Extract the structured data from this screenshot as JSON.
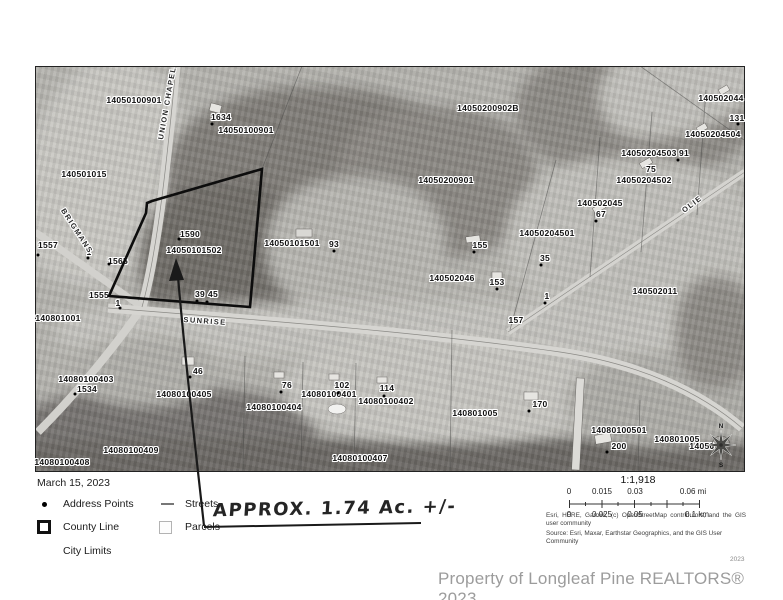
{
  "map": {
    "labels": [
      {
        "t": "14050100901",
        "x": 134,
        "y": 100
      },
      {
        "t": "1634",
        "x": 221,
        "y": 117
      },
      {
        "t": "14050100901",
        "x": 246,
        "y": 130
      },
      {
        "t": "140501015",
        "x": 84,
        "y": 174
      },
      {
        "t": "14050200902B",
        "x": 488,
        "y": 108
      },
      {
        "t": "14050200901",
        "x": 446,
        "y": 180
      },
      {
        "t": "140502044",
        "x": 721,
        "y": 98
      },
      {
        "t": "131",
        "x": 737,
        "y": 118
      },
      {
        "t": "14050204504",
        "x": 713,
        "y": 134
      },
      {
        "t": "14050204503",
        "x": 649,
        "y": 153
      },
      {
        "t": "91",
        "x": 684,
        "y": 153
      },
      {
        "t": "75",
        "x": 651,
        "y": 169
      },
      {
        "t": "14050204502",
        "x": 644,
        "y": 180
      },
      {
        "t": "140502045",
        "x": 600,
        "y": 203
      },
      {
        "t": "67",
        "x": 601,
        "y": 214
      },
      {
        "t": "14050204501",
        "x": 547,
        "y": 233
      },
      {
        "t": "140502011",
        "x": 655,
        "y": 291
      },
      {
        "t": "1557",
        "x": 48,
        "y": 245
      },
      {
        "t": "1",
        "x": 89,
        "y": 252
      },
      {
        "t": "1565",
        "x": 118,
        "y": 261
      },
      {
        "t": "1555",
        "x": 99,
        "y": 295
      },
      {
        "t": "1",
        "x": 118,
        "y": 303
      },
      {
        "t": "140801001",
        "x": 58,
        "y": 318
      },
      {
        "t": "1590",
        "x": 190,
        "y": 234
      },
      {
        "t": "14050101502",
        "x": 194,
        "y": 250
      },
      {
        "t": "39",
        "x": 200,
        "y": 294
      },
      {
        "t": "45",
        "x": 213,
        "y": 294
      },
      {
        "t": "14050101501",
        "x": 292,
        "y": 243
      },
      {
        "t": "93",
        "x": 334,
        "y": 244
      },
      {
        "t": "155",
        "x": 480,
        "y": 245
      },
      {
        "t": "35",
        "x": 545,
        "y": 258
      },
      {
        "t": "140502046",
        "x": 452,
        "y": 278
      },
      {
        "t": "153",
        "x": 497,
        "y": 282
      },
      {
        "t": "1",
        "x": 547,
        "y": 296
      },
      {
        "t": "157",
        "x": 516,
        "y": 320
      },
      {
        "t": "14080100403",
        "x": 86,
        "y": 379
      },
      {
        "t": "1534",
        "x": 87,
        "y": 389
      },
      {
        "t": "46",
        "x": 198,
        "y": 371
      },
      {
        "t": "14080100405",
        "x": 184,
        "y": 394
      },
      {
        "t": "76",
        "x": 287,
        "y": 385
      },
      {
        "t": "14080100404",
        "x": 274,
        "y": 407
      },
      {
        "t": "102",
        "x": 342,
        "y": 385
      },
      {
        "t": "14080100401",
        "x": 329,
        "y": 394
      },
      {
        "t": "114",
        "x": 387,
        "y": 388
      },
      {
        "t": "14080100402",
        "x": 386,
        "y": 401
      },
      {
        "t": "14080100407",
        "x": 360,
        "y": 458
      },
      {
        "t": "14080100409",
        "x": 131,
        "y": 450
      },
      {
        "t": "14080100408",
        "x": 62,
        "y": 462
      },
      {
        "t": "140801005",
        "x": 475,
        "y": 413
      },
      {
        "t": "170",
        "x": 540,
        "y": 404
      },
      {
        "t": "14080100501",
        "x": 619,
        "y": 430
      },
      {
        "t": "200",
        "x": 619,
        "y": 446
      },
      {
        "t": "140801005",
        "x": 677,
        "y": 439
      },
      {
        "t": "14050",
        "x": 702,
        "y": 446
      },
      {
        "t": "UNION CHAPEL",
        "x": 167,
        "y": 103,
        "rot": -80,
        "cls": "road"
      },
      {
        "t": "BRIGMANS",
        "x": 77,
        "y": 231,
        "rot": 57,
        "cls": "road"
      },
      {
        "t": "SUNRISE",
        "x": 205,
        "y": 321,
        "rot": 4,
        "cls": "road"
      },
      {
        "t": "OLIE",
        "x": 692,
        "y": 204,
        "rot": -37,
        "cls": "road"
      }
    ],
    "dots": [
      [
        38,
        255
      ],
      [
        88,
        258
      ],
      [
        109,
        264
      ],
      [
        120,
        308
      ],
      [
        179,
        239
      ],
      [
        212,
        124
      ],
      [
        334,
        251
      ],
      [
        474,
        252
      ],
      [
        541,
        265
      ],
      [
        497,
        289
      ],
      [
        545,
        303
      ],
      [
        197,
        301
      ],
      [
        207,
        302
      ],
      [
        190,
        377
      ],
      [
        281,
        392
      ],
      [
        338,
        393
      ],
      [
        384,
        396
      ],
      [
        75,
        394
      ],
      [
        529,
        411
      ],
      [
        607,
        452
      ],
      [
        738,
        124
      ],
      [
        678,
        160
      ],
      [
        596,
        221
      ]
    ],
    "compass": {
      "north": "N",
      "south": "S"
    }
  },
  "annotation": {
    "text": "APPROX.  1.74 Ac. +/-"
  },
  "legend": {
    "date": "March 15, 2023",
    "items": [
      {
        "icon": "address-point",
        "label": "Address Points"
      },
      {
        "icon": "street-line",
        "label": "Streets"
      },
      {
        "icon": "county-line-square",
        "label": "County Line"
      },
      {
        "icon": "parcel-square",
        "label": "Parcels"
      },
      {
        "icon": "none",
        "label": "City Limits"
      }
    ]
  },
  "scalebar": {
    "ratio": "1:1,918",
    "mi": [
      "0",
      "0.015",
      "0.03",
      "0.06 mi"
    ],
    "km": [
      "0",
      "0.025",
      "0.05",
      "0.1 km"
    ],
    "attribution": "Esri, HERE, Garmin, (c) OpenStreetMap contributors, and the GIS user community",
    "source": "Source: Esri, Maxar, Earthstar Geographics, and the GIS User Community"
  },
  "footer": {
    "year_small": "2023",
    "copyright": "Property of Longleaf Pine REALTORS® 2023"
  },
  "colors": {
    "boundary": "#0d0d0d",
    "page": "#ffffff",
    "halo": "#ffffff"
  }
}
